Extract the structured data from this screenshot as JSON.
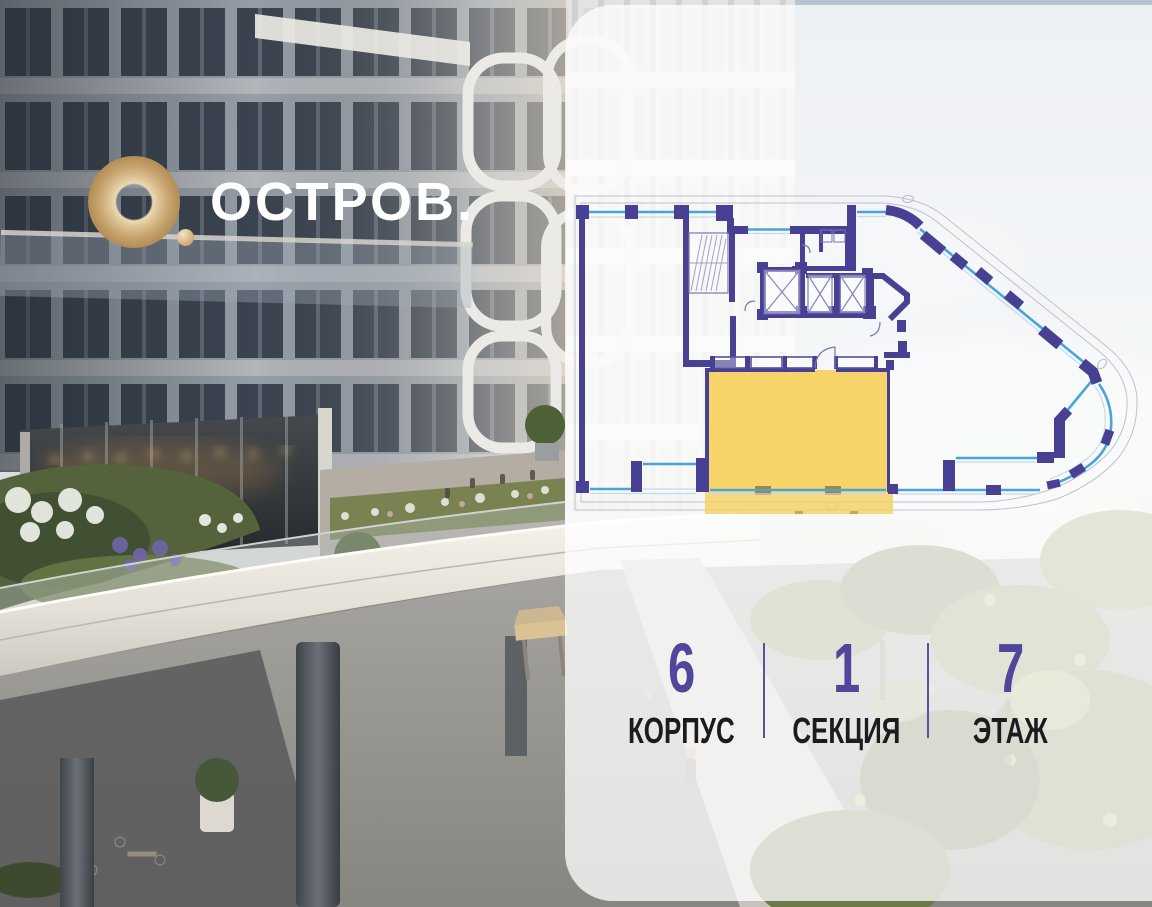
{
  "logo": {
    "brand": "ОСТРОВ."
  },
  "unit_info": {
    "items": [
      {
        "value": "6",
        "label": "КОРПУС"
      },
      {
        "value": "1",
        "label": "СЕКЦИЯ"
      },
      {
        "value": "7",
        "label": "ЭТАЖ"
      }
    ]
  },
  "floorplan": {
    "highlighted_unit": {
      "building": "6",
      "section": "1",
      "floor": "7"
    },
    "colors": {
      "walls": "#474093",
      "windows": "#47a5da",
      "highlight": "#f5d160",
      "accent_text": "#50469c",
      "logo_gold": "#d4b584"
    }
  }
}
